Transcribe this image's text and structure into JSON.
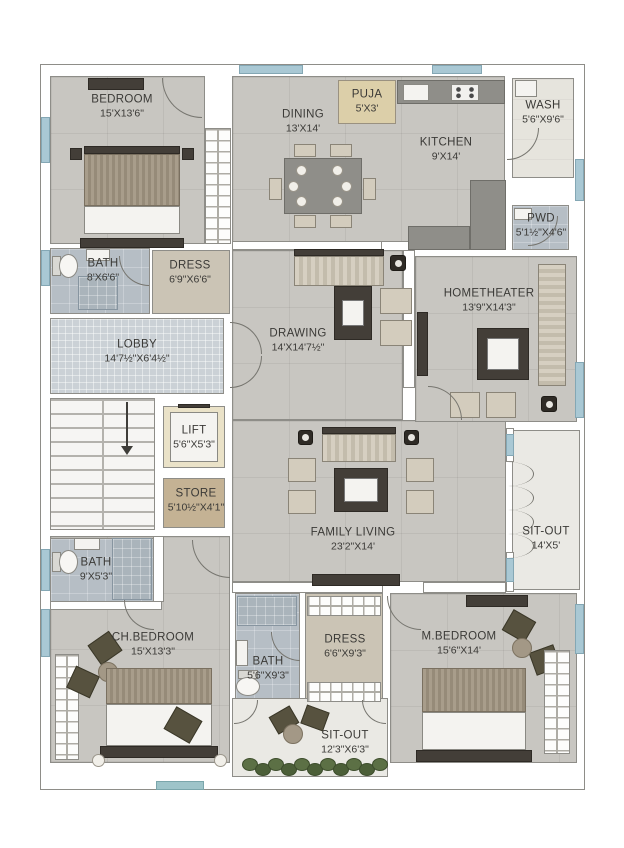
{
  "document": {
    "type": "apartment-floor-plan",
    "background": "#ffffff"
  },
  "palette": {
    "wall_outline": "#8e8d88",
    "floor_main": "#c8c6c1",
    "floor_lobby": "#cbd1d6",
    "floor_bath": "#b6bec5",
    "floor_dress": "#cbc4b5",
    "floor_puja": "#dccfa9",
    "floor_lift": "#eae2c8",
    "floor_store": "#c4b294",
    "floor_wash": "#e6e4dd",
    "floor_sitout": "#eae9e4",
    "window_blue": "#a9c8d4",
    "window_teal": "#9ec4c9",
    "furniture_dark": "#433e38",
    "sofa_beige": "#cfc8ba",
    "plant_green": "#5c7045",
    "text": "#3b3a37"
  },
  "rooms": [
    {
      "id": "bedroom",
      "name": "BEDROOM",
      "dims": "15'X13'6\""
    },
    {
      "id": "dining",
      "name": "DINING",
      "dims": "13'X14'"
    },
    {
      "id": "puja",
      "name": "PUJA",
      "dims": "5'X3'"
    },
    {
      "id": "kitchen",
      "name": "KITCHEN",
      "dims": "9'X14'"
    },
    {
      "id": "wash",
      "name": "WASH",
      "dims": "5'6\"X9'6\""
    },
    {
      "id": "pwd",
      "name": "PWD",
      "dims": "5'1½\"X4'6\""
    },
    {
      "id": "bath-top",
      "name": "BATH",
      "dims": "8'X6'6\""
    },
    {
      "id": "dress-top",
      "name": "DRESS",
      "dims": "6'9\"X6'6\""
    },
    {
      "id": "lobby",
      "name": "LOBBY",
      "dims": "14'7½\"X6'4½\""
    },
    {
      "id": "drawing",
      "name": "DRAWING",
      "dims": "14'X14'7½\""
    },
    {
      "id": "lift",
      "name": "LIFT",
      "dims": "5'6\"X5'3\""
    },
    {
      "id": "store",
      "name": "STORE",
      "dims": "5'10½\"X4'1\""
    },
    {
      "id": "hometheater",
      "name": "HOMETHEATER",
      "dims": "13'9\"X14'3\""
    },
    {
      "id": "family-living",
      "name": "FAMILY LIVING",
      "dims": "23'2\"X14'"
    },
    {
      "id": "sitout-right",
      "name": "SIT-OUT",
      "dims": "14'X5'"
    },
    {
      "id": "bath-left",
      "name": "BATH",
      "dims": "9'X5'3\""
    },
    {
      "id": "ch-bedroom",
      "name": "CH.BEDROOM",
      "dims": "15'X13'3\""
    },
    {
      "id": "bath-bottom",
      "name": "BATH",
      "dims": "5'6\"X9'3\""
    },
    {
      "id": "dress-bottom",
      "name": "DRESS",
      "dims": "6'6\"X9'3\""
    },
    {
      "id": "m-bedroom",
      "name": "M.BEDROOM",
      "dims": "15'6\"X14'"
    },
    {
      "id": "sitout-bottom",
      "name": "SIT-OUT",
      "dims": "12'3\"X6'3\""
    }
  ],
  "stairs": {
    "direction_arrow": "down"
  }
}
